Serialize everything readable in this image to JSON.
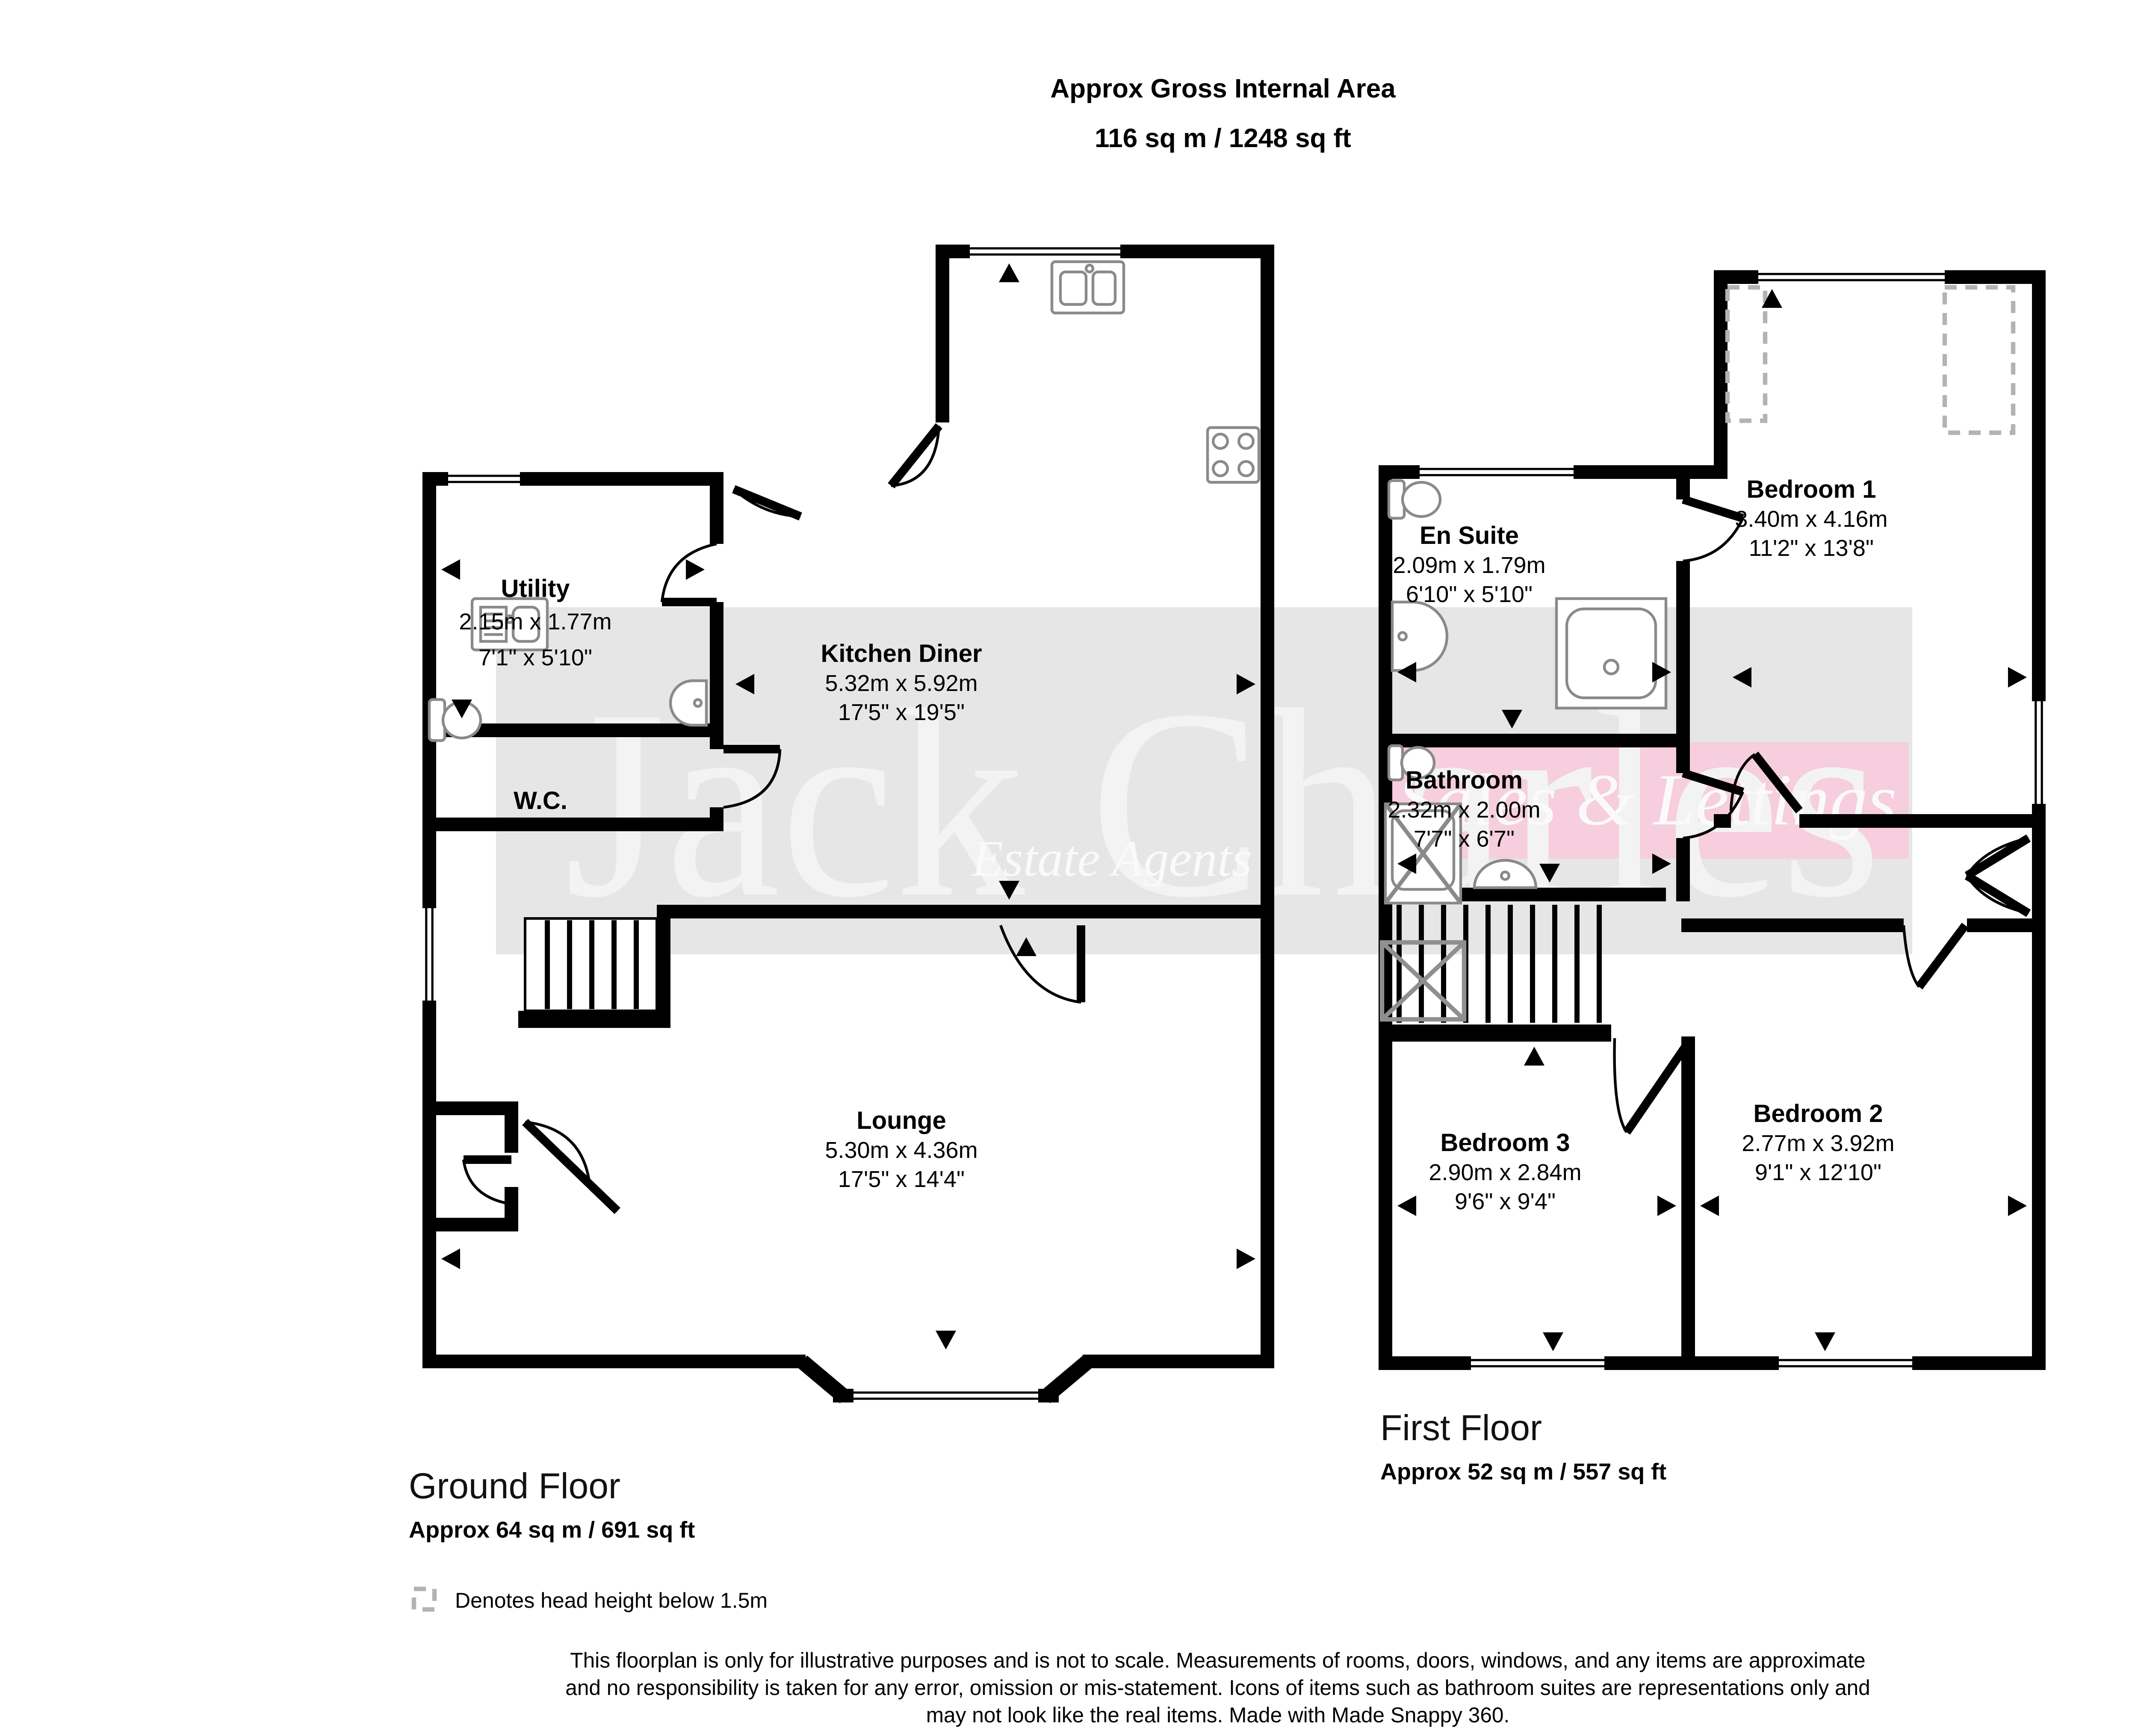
{
  "title": {
    "line1": "Approx Gross Internal Area",
    "line2": "116 sq m / 1248 sq ft"
  },
  "compass": {
    "n": "N",
    "e": "E",
    "s": "S",
    "w": "W"
  },
  "colors": {
    "watermark_band": "#e6e6e6",
    "banner_band": "#f6cede",
    "wall": "#000000"
  },
  "watermark": {
    "brand": "Jack Charles",
    "tagline": "Estate Agents",
    "banner": "Sales & Lettings"
  },
  "ground_floor": {
    "caption": "Ground Floor",
    "area": "Approx 64 sq m / 691 sq ft",
    "rooms": {
      "utility": {
        "name": "Utility",
        "metric": "2.15m x 1.77m",
        "imperial": "7'1\" x 5'10\""
      },
      "wc": {
        "name": "W.C."
      },
      "kitchen": {
        "name": "Kitchen Diner",
        "metric": "5.32m x 5.92m",
        "imperial": "17'5\" x 19'5\""
      },
      "lounge": {
        "name": "Lounge",
        "metric": "5.30m x 4.36m",
        "imperial": "17'5\" x 14'4\""
      }
    }
  },
  "first_floor": {
    "caption": "First Floor",
    "area": "Approx 52 sq m / 557 sq ft",
    "rooms": {
      "ensuite": {
        "name": "En Suite",
        "metric": "2.09m x 1.79m",
        "imperial": "6'10\" x 5'10\""
      },
      "bedroom1": {
        "name": "Bedroom 1",
        "metric": "3.40m x 4.16m",
        "imperial": "11'2\" x 13'8\""
      },
      "bathroom": {
        "name": "Bathroom",
        "metric": "2.32m x 2.00m",
        "imperial": "7'7\" x 6'7\""
      },
      "bedroom3": {
        "name": "Bedroom 3",
        "metric": "2.90m x 2.84m",
        "imperial": "9'6\" x 9'4\""
      },
      "bedroom2": {
        "name": "Bedroom 2",
        "metric": "2.77m x 3.92m",
        "imperial": "9'1\" x 12'10\""
      }
    }
  },
  "legend": {
    "head_height": "Denotes head height below 1.5m"
  },
  "disclaimer": {
    "line1": "This floorplan is only for illustrative purposes and is not to scale. Measurements of rooms, doors, windows, and any items are approximate",
    "line2": "and no responsibility is taken for any error, omission or mis-statement. Icons of items such as bathroom suites are representations only and",
    "line3": "may not look like the real items. Made with Made Snappy 360."
  }
}
